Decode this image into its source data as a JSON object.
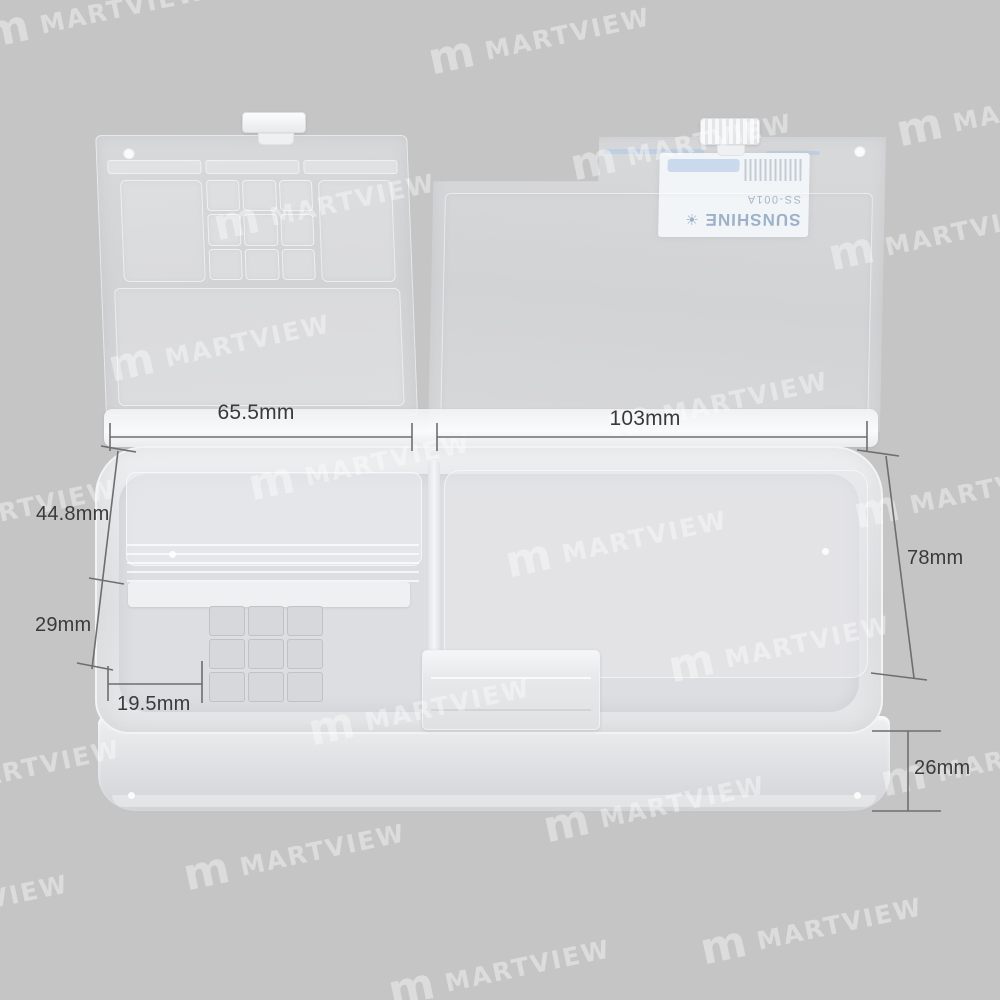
{
  "brand_label": {
    "brand": "SUNSHINE",
    "model": "SS-001A",
    "sun_glyph": "☀"
  },
  "watermarks": {
    "text": "MARTVIEW",
    "logo_glyph": "m",
    "positions": [
      {
        "x": 95,
        "y": 14
      },
      {
        "x": 540,
        "y": 40
      },
      {
        "x": 1008,
        "y": 112
      },
      {
        "x": 325,
        "y": 206
      },
      {
        "x": 682,
        "y": 146
      },
      {
        "x": 940,
        "y": 236
      },
      {
        "x": 220,
        "y": 347
      },
      {
        "x": 718,
        "y": 404
      },
      {
        "x": 360,
        "y": 466
      },
      {
        "x": 6,
        "y": 512
      },
      {
        "x": 617,
        "y": 543
      },
      {
        "x": 965,
        "y": 494
      },
      {
        "x": 780,
        "y": 648
      },
      {
        "x": 420,
        "y": 711
      },
      {
        "x": 10,
        "y": 772
      },
      {
        "x": 992,
        "y": 762
      },
      {
        "x": 295,
        "y": 856
      },
      {
        "x": 655,
        "y": 808
      },
      {
        "x": -42,
        "y": 907
      },
      {
        "x": 812,
        "y": 930
      },
      {
        "x": 500,
        "y": 972
      }
    ]
  },
  "dimension_annotations": {
    "lid_left_width": "65.5mm",
    "lid_right_width": "103mm",
    "back_wall_height": "44.8mm",
    "front_wall_height": "29mm",
    "corner_offset": "19.5mm",
    "box_depth": "78mm",
    "base_height": "26mm"
  },
  "colors": {
    "background": "#c5c5c6",
    "box_plastic": "#dddee1",
    "rim_highlight": "#f2f3f5",
    "dimension_line": "#6e6e70",
    "dimension_text": "#3a3a3b",
    "label_blue": "#c2d5e9",
    "brand_text": "#9db1c9",
    "watermark": "#ffffff"
  }
}
